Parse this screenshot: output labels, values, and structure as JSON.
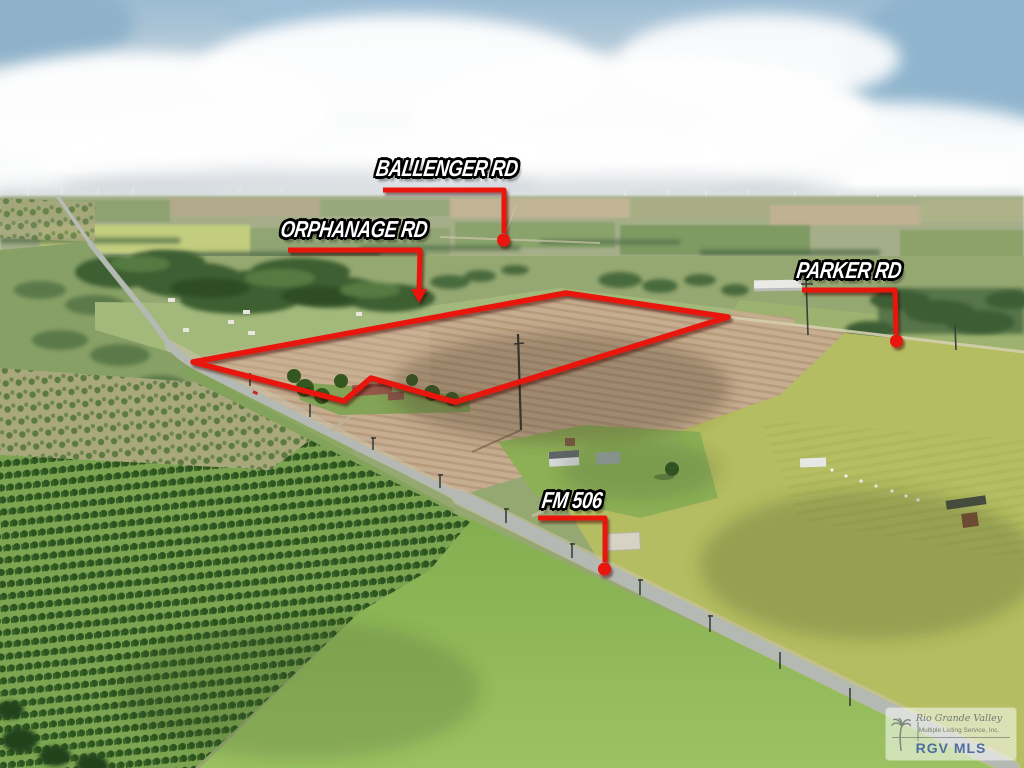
{
  "scene": {
    "description": "Aerial drone photo of rural farmland with a red-outlined land parcel, road callout labels and an MLS watermark"
  },
  "road_labels": {
    "ballenger": "BALLENGER RD",
    "orphanage": "ORPHANAGE RD",
    "parker": "PARKER RD",
    "fm506": "FM 506"
  },
  "watermark": {
    "brand_script": "Rio Grande Valley",
    "brand_sub": "Multiple Listing Service, Inc.",
    "brand_abbr": "RGV MLS"
  },
  "colors": {
    "annotation_red": "#e8150a",
    "watermark_blue": "#4d6e9e"
  }
}
